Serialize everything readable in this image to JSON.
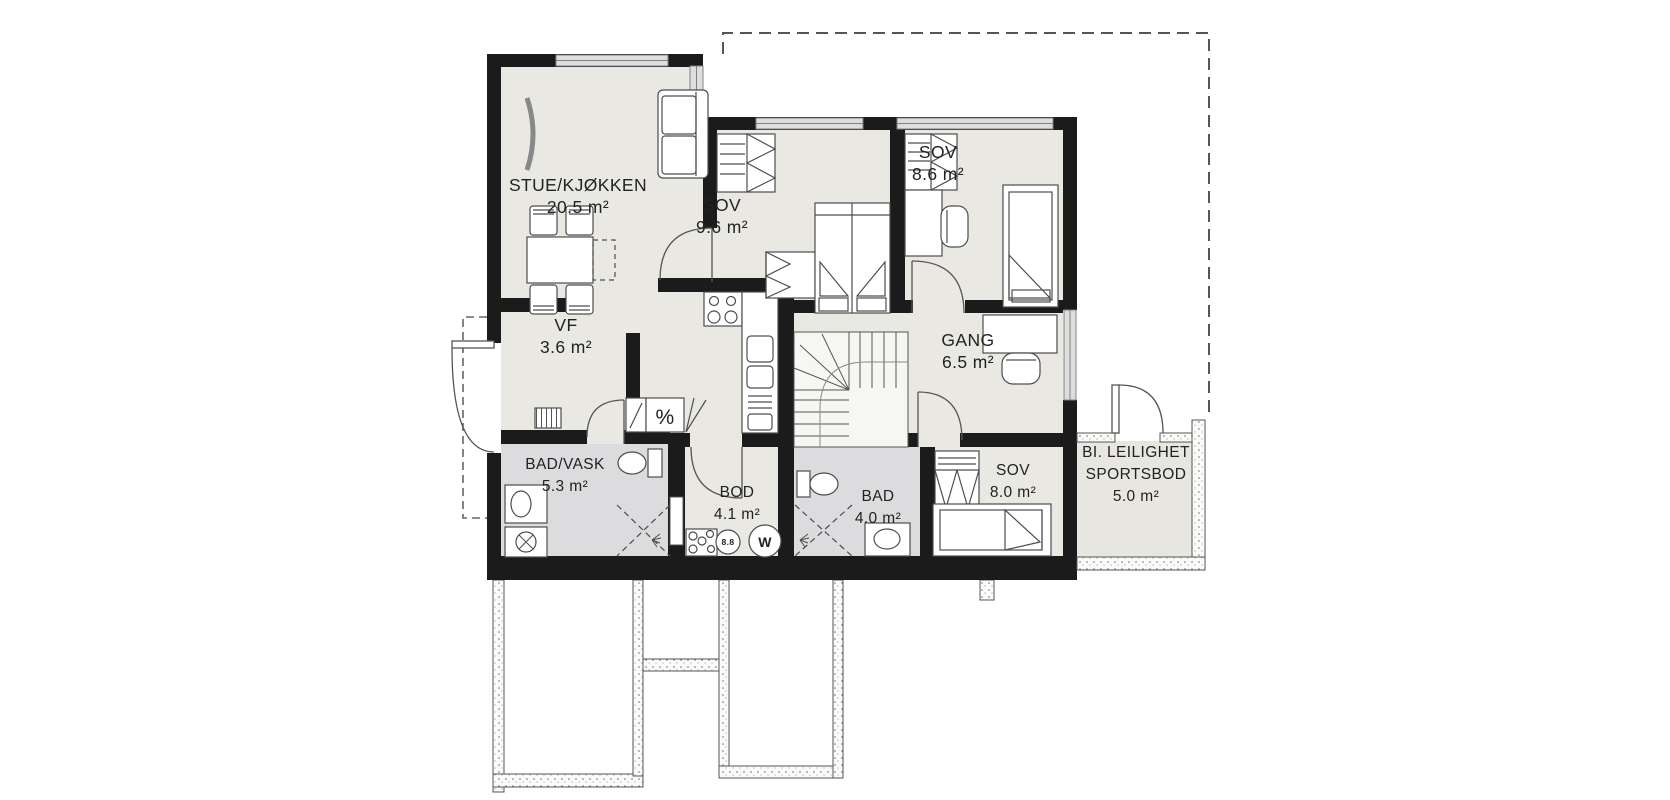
{
  "rooms": {
    "stue": {
      "name": "STUE/KJØKKEN",
      "area": "20.5 m²"
    },
    "sov1": {
      "name": "SOV",
      "area": "9.6 m²"
    },
    "sov2": {
      "name": "SOV",
      "area": "8.6 m²"
    },
    "vf": {
      "name": "VF",
      "area": "3.6 m²"
    },
    "gang": {
      "name": "GANG",
      "area": "6.5 m²"
    },
    "badvask": {
      "name": "BAD/VASK",
      "area": "5.3 m²"
    },
    "bod": {
      "name": "BOD",
      "area": "4.1 m²"
    },
    "bad": {
      "name": "BAD",
      "area": "4.0 m²"
    },
    "sov3": {
      "name": "SOV",
      "area": "8.0 m²"
    },
    "sportsbod": {
      "line1": "BI. LEILIGHET",
      "line2": "SPORTSBOD",
      "area": "5.0 m²"
    }
  },
  "symbols": {
    "water_heater": "W",
    "drain": "8.8",
    "tech_percent": "%"
  },
  "colors": {
    "wall": "#1b1b1b",
    "floor": "#e9e8e2",
    "wet_floor": "#dcdcde",
    "furniture_line": "#4d4d4d",
    "window_fill": "#dedede"
  }
}
